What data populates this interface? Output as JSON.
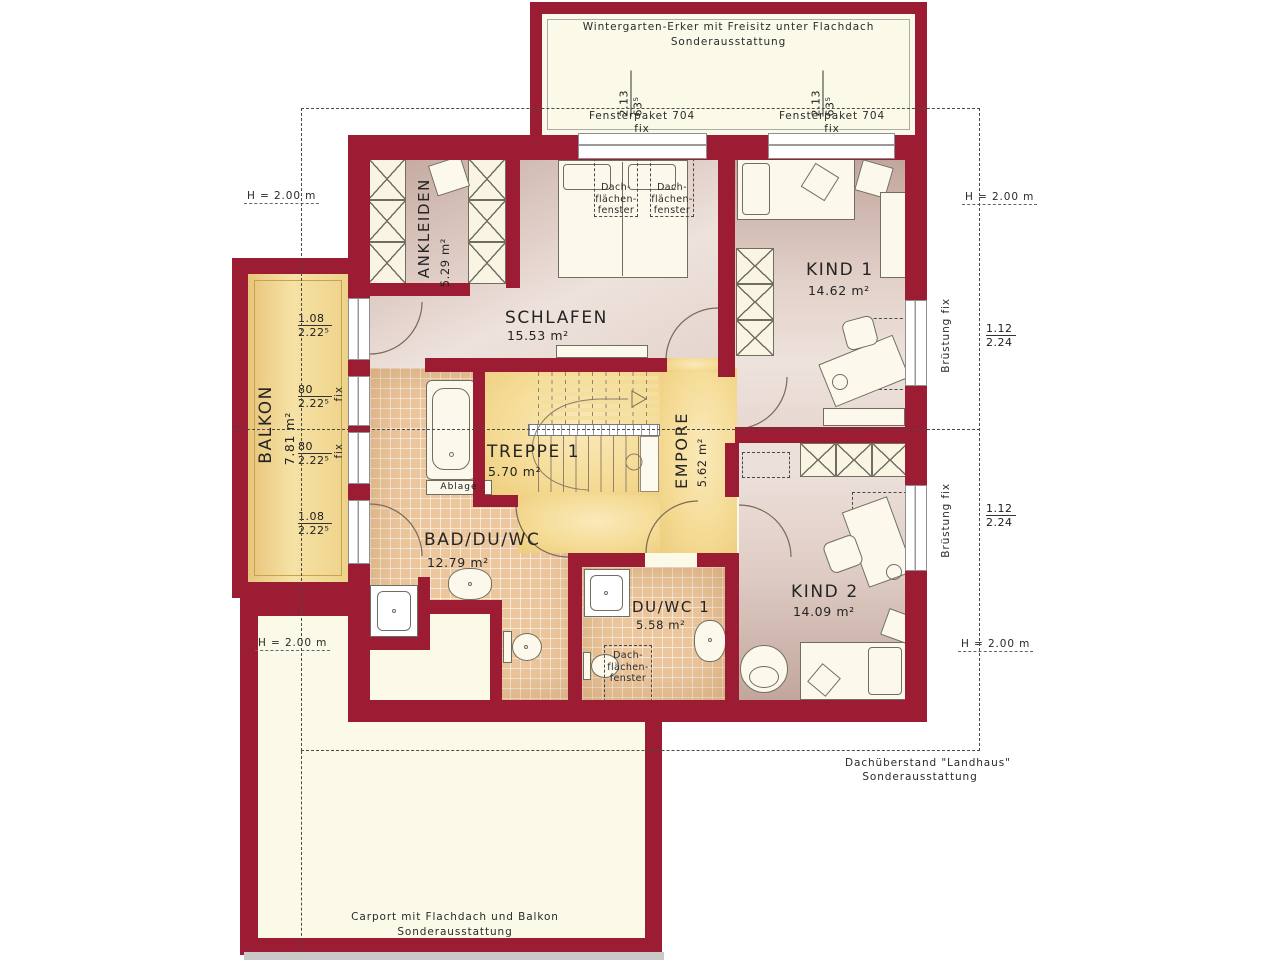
{
  "plan": {
    "wintergarten": {
      "line1": "Wintergarten-Erker mit Freisitz unter Flachdach",
      "line2": "Sonderausstattung"
    },
    "carport": {
      "line1": "Carport mit Flachdach und Balkon",
      "line2": "Sonderausstattung"
    },
    "dachueberstand": {
      "line1": "Dachüberstand \"Landhaus\"",
      "line2": "Sonderausstattung"
    },
    "height_marker": "H = 2.00 m",
    "ablage": "Ablage",
    "roof_window": {
      "l1": "Dach-",
      "l2": "flächen-",
      "l3": "fenster"
    }
  },
  "rooms": {
    "schlafen": {
      "name": "SCHLAFEN",
      "area": "15.53 m²"
    },
    "ankleiden": {
      "name": "ANKLEIDEN",
      "area": "5.29 m²"
    },
    "kind1": {
      "name": "KIND 1",
      "area": "14.62 m²"
    },
    "kind2": {
      "name": "KIND 2",
      "area": "14.09 m²"
    },
    "bad": {
      "name": "BAD/DU/WC",
      "area": "12.79 m²"
    },
    "duwc1": {
      "name": "DU/WC 1",
      "area": "5.58 m²"
    },
    "treppe": {
      "name": "TREPPE 1",
      "area": "5.70 m²"
    },
    "empore": {
      "name": "EMPORE",
      "area": "5.62 m²"
    },
    "balkon": {
      "name": "BALKON",
      "area": "7.81 m²"
    }
  },
  "windows": {
    "top": [
      {
        "package": "Fensterpaket 704",
        "fix": "fix",
        "w": "2.13",
        "h": "63⁵"
      },
      {
        "package": "Fensterpaket 704",
        "fix": "fix",
        "w": "2.13",
        "h": "63⁵"
      }
    ],
    "balcony": [
      {
        "w": "1.08",
        "h": "2.22⁵"
      },
      {
        "w": "80",
        "h": "2.22⁵",
        "fix": "fix"
      },
      {
        "w": "80",
        "h": "2.22⁵",
        "fix": "fix"
      },
      {
        "w": "1.08",
        "h": "2.22⁵"
      }
    ],
    "right": [
      {
        "label": "Brüstung fix",
        "w": "1.12",
        "h": "2.24"
      },
      {
        "label": "Brüstung fix",
        "w": "1.12",
        "h": "2.24"
      }
    ]
  },
  "colors": {
    "wall": "#9b1c33",
    "floor": "#e8dad3",
    "hall": "#f5dc97",
    "tile": "#ecc79e",
    "cream": "#fbf9e8"
  }
}
